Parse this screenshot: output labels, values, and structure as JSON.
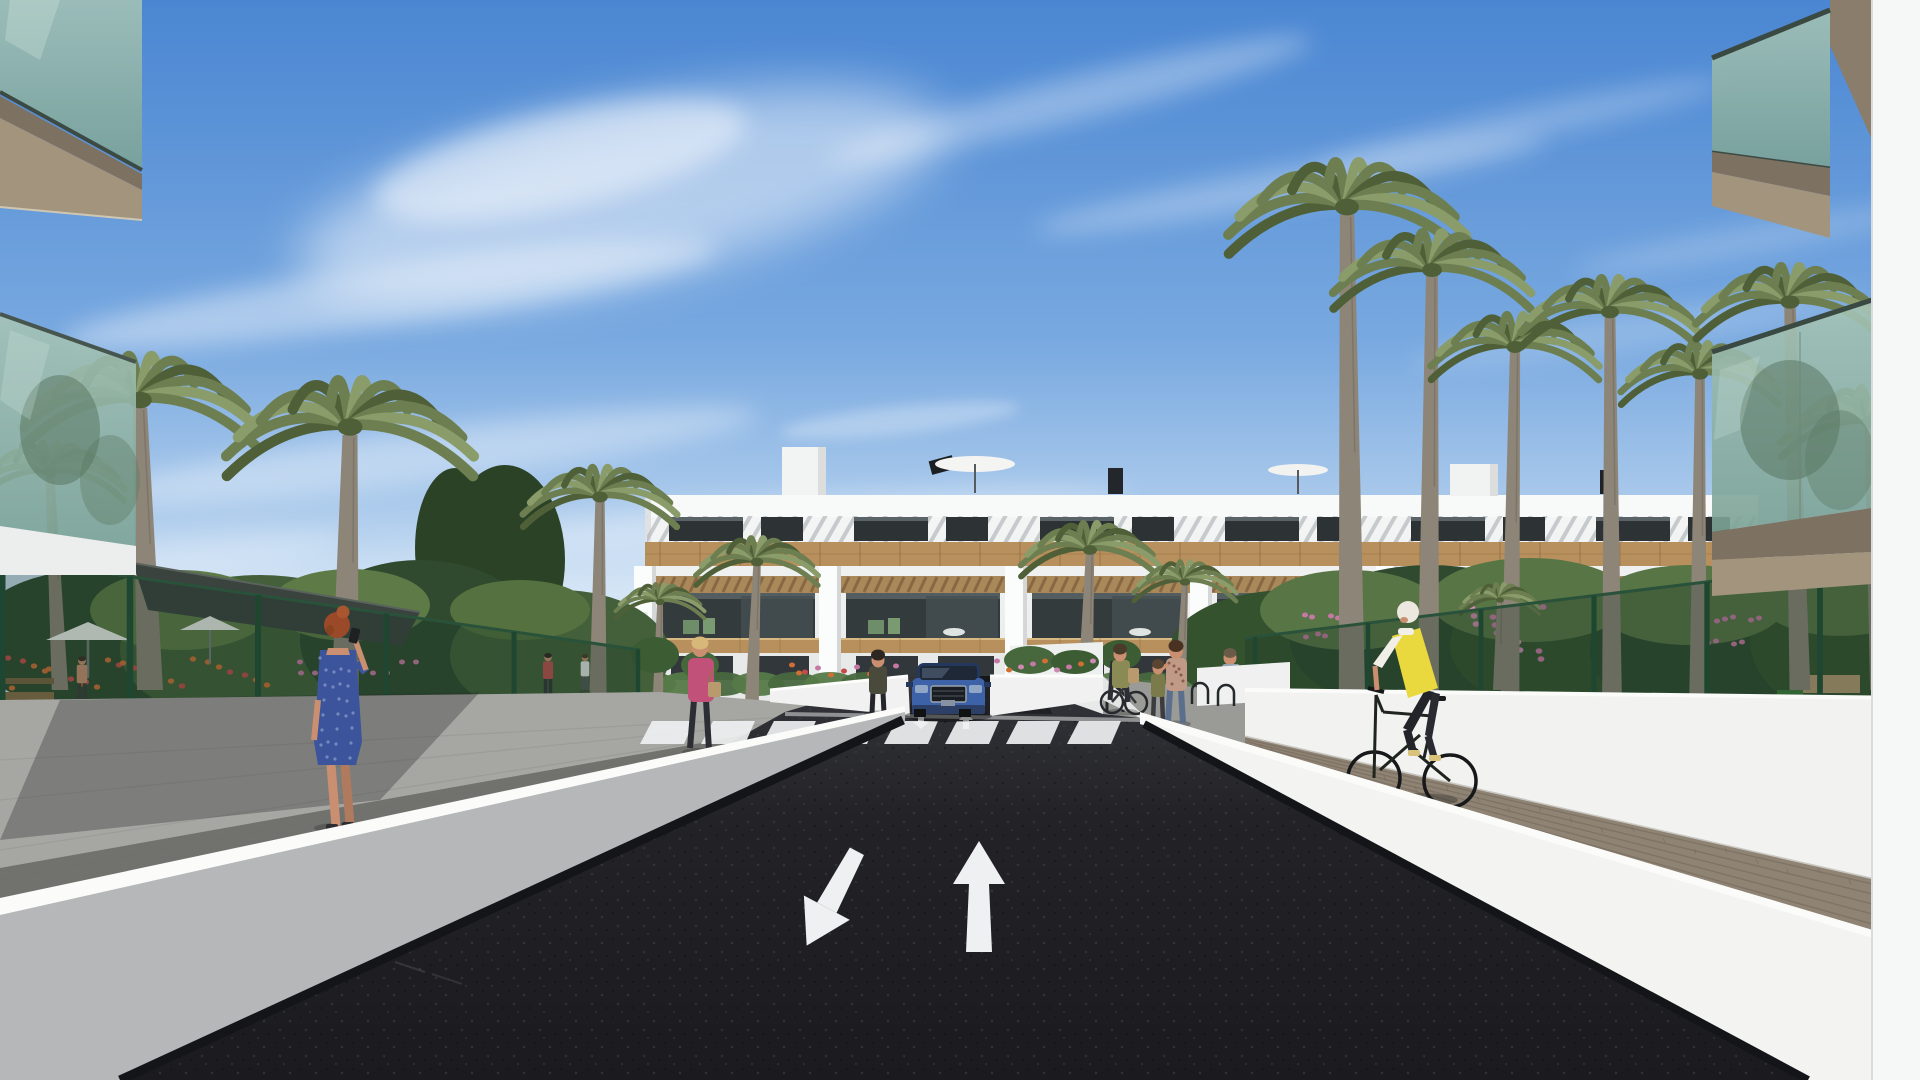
{
  "meta": {
    "type": "3d-architectural-rendering"
  },
  "scene": {
    "description": "Sunny 3D architectural rendering: street approach to a modern white three-storey apartment complex with wood pergola balconies, palm trees, glass-railing foreground balconies, pedestrians, a cyclist in a yellow vest, and a blue SUV at a garage ramp behind a zebra crosswalk.",
    "sky": {
      "weather": "sunny",
      "clouds": "wispy cirrus streaks"
    },
    "road": {
      "surface": "dark asphalt",
      "markings": [
        "straight-ahead-arrow",
        "oncoming-turn-arrow",
        "ramp-entry-arrow",
        "ramp-exit-arrow",
        "zebra-crosswalk"
      ],
      "crosswalk_stripes": 8
    },
    "building": {
      "floors": 3,
      "bays": 6,
      "style": "white render, wood cladding band, pergola balconies, rooftop terraces with parasols"
    },
    "vehicles": [
      "blue-suv-at-garage-ramp"
    ],
    "people": [
      "woman-blue-dress-on-phone",
      "woman-pink-jacket-with-bag",
      "woman-dark-top-standing",
      "woman-walking-bicycle",
      "woman-with-child",
      "child",
      "woman-behind-garden-wall",
      "cyclist-yellow-vest",
      "man-in-garden"
    ],
    "landscape": [
      "palm-trees",
      "green-mesh-fences",
      "shade-sail-canopy",
      "white-umbrellas",
      "flower-beds"
    ]
  },
  "colors": {
    "skyTop": "#4a86d2",
    "skyMid": "#79a9e0",
    "skyLow": "#c6dcf2",
    "skyHorizon": "#e2eef9",
    "cloud": "#ffffff",
    "facade": "#f3f4f4",
    "facadeShade": "#dfe1e2",
    "parapet": "#f8f9f9",
    "wood": "#b8905e",
    "woodDark": "#8f6c40",
    "woodLight": "#d8b984",
    "windowDark": "#2d3234",
    "openingDark": "#343b3d",
    "pergola": "#a9885a",
    "slatShadow": "#7c5e3a",
    "pillar": "#fbfcfc",
    "hedge1": "#49683f",
    "hedge2": "#567a48",
    "foliageDark": "#2f4a2e",
    "foliage": "#43603a",
    "foliageLight": "#5d7a47",
    "palmDark": "#4f6038",
    "palmGreen": "#6d7f50",
    "palmLight": "#8b9c6b",
    "trunk": "#8d8577",
    "fencePost": "#1e4630",
    "fenceMesh": "rgba(22,52,35,0.30)",
    "canopy": "#3b433f",
    "walkway": "#a6a6a2",
    "walkwayDark": "#6b6b67",
    "paver": "#8f8374",
    "paverJoint": "#6e6457",
    "concrete": "#9a9b97",
    "wallFaceL": "#b5b7b9",
    "wallFaceR": "#f3f4f2",
    "wallTop": "#fbfbfa",
    "wallBase": "#141518",
    "asphaltTop": "#34353b",
    "asphalt": "#232327",
    "asphaltDeep": "#1b1b1f",
    "marking": "#eef0f1",
    "glass": "#8fb1a4",
    "glassDeep": "#6c9184",
    "fascia": "#8a7d6c",
    "fasciaDark": "#7d7262",
    "fasciaLight": "#a3957d",
    "whiteStrip": "#f6f7f7",
    "suv": "#3d62a8",
    "suvDark": "#24375d",
    "grille": "#1a1d22",
    "skin": "#c98f70",
    "dressBlue": "#3c549c",
    "dressDot": "#8fa0cc",
    "hairAuburn": "#9a4a28",
    "jacketPink": "#c2517a",
    "hairBlonde": "#d8b878",
    "vestYellow": "#ead83f",
    "hairWhite": "#ece8df",
    "oliveTop": "#8a8a55",
    "bagTan": "#b89a6e",
    "floralTop": "#c09a86",
    "jeans": "#5b6e8c",
    "flowerOrange": "#cf6f35",
    "flowerRed": "#c44b49",
    "flowerPink": "#c678a4",
    "benchWood": "#8a6f4a",
    "umbrellaWhite": "#f1f2ef"
  }
}
